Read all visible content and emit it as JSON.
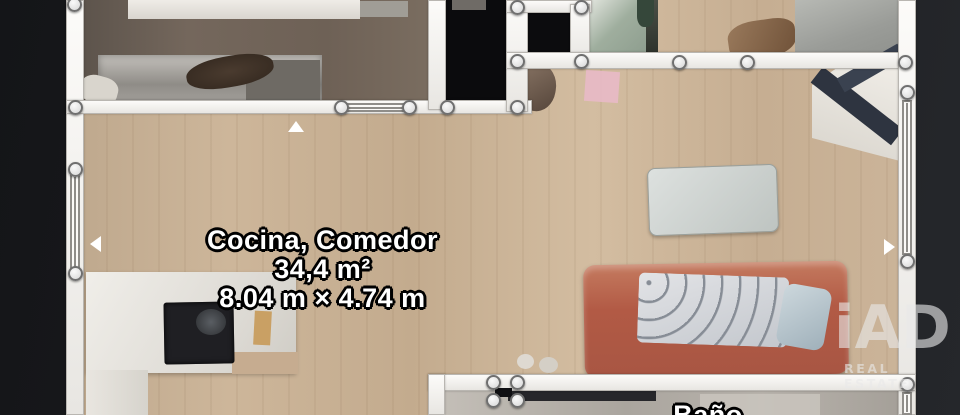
{
  "page": {
    "type": "floorplan-3d-scan-top-view"
  },
  "labels": {
    "main_room": {
      "name": "Cocina, Comedor",
      "area": "34,4 m²",
      "dimensions": "8.04 m × 4.74 m"
    },
    "bottom_room": {
      "name": "Baño"
    }
  },
  "watermark": {
    "logo": "iAD",
    "subtitle": "REAL ESTATE"
  },
  "colors": {
    "background": "#1c1d20",
    "wall": "#f4f2ef",
    "wall_node_fill": "#ececec",
    "wood_floor": "#c8ae93",
    "void_room": "#0b0b0d",
    "sofa": "#b25a45",
    "label_text": "#ffffff",
    "label_outline": "#000000",
    "watermark_gray": "#e9e9e9"
  },
  "scene": {
    "width": 960,
    "height": 415,
    "shapes": [
      {
        "name": "canvas-background",
        "interactable": false,
        "x": 0,
        "y": 0,
        "w": 960,
        "h": 415,
        "bg": "linear-gradient(100deg,#141518 0%,#1b1c1f 45%,#25272b 100%)"
      },
      {
        "name": "main-wood-floor",
        "interactable": false,
        "x": 80,
        "y": 0,
        "w": 828,
        "h": 415,
        "bg": "repeating-linear-gradient(90deg,rgba(90,60,30,0.06) 0 2px,rgba(0,0,0,0) 2px 26px),linear-gradient(90deg,#bfa98e 0%,#cdb69a 18%,#c3ab8e 40%,#d3bda1 62%,#c6ae92 82%,#cbb499 100%)"
      },
      {
        "name": "room-top-left-floor",
        "interactable": false,
        "x": 84,
        "y": 0,
        "w": 346,
        "h": 103,
        "bg": "linear-gradient(90deg,#5d544c,#74675c 30%,#6e6156 70%,#7a6d60)"
      },
      {
        "name": "bed-step",
        "interactable": false,
        "x": 350,
        "y": 1,
        "w": 58,
        "h": 16,
        "bg": "#a09d96"
      },
      {
        "name": "bed-white",
        "interactable": false,
        "x": 128,
        "y": 0,
        "w": 232,
        "h": 19,
        "bg": "linear-gradient(180deg,#efece7,#d9d5cf)"
      },
      {
        "name": "desk-unit",
        "interactable": false,
        "x": 98,
        "y": 55,
        "w": 224,
        "h": 49,
        "bg": "linear-gradient(180deg,#c4c1bc,#8f8c87 60%,#a5a29d)",
        "shadow": "inset 0 0 8px rgba(0,0,0,0.35)"
      },
      {
        "name": "desk-unit-shelf",
        "interactable": false,
        "x": 246,
        "y": 60,
        "w": 74,
        "h": 42,
        "bg": "#6e6a64"
      },
      {
        "name": "desk-chair-blob",
        "interactable": false,
        "x": 186,
        "y": 56,
        "w": 88,
        "h": 31,
        "bg": "radial-gradient(ellipse at 50% 50%,#4a3b2f,#32271e)",
        "radius": "45%",
        "rotate": -10
      },
      {
        "name": "pillow-blob",
        "interactable": false,
        "x": 80,
        "y": 76,
        "w": 38,
        "h": 28,
        "bg": "#d9d5cd",
        "radius": "40%",
        "rotate": 15
      },
      {
        "name": "void-room-a",
        "interactable": false,
        "x": 446,
        "y": 0,
        "w": 61,
        "h": 104,
        "bg": "#0b0b0d"
      },
      {
        "name": "void-room-a-object",
        "interactable": false,
        "x": 452,
        "y": 0,
        "w": 34,
        "h": 10,
        "bg": "#6f6b66"
      },
      {
        "name": "void-room-b",
        "interactable": false,
        "x": 528,
        "y": 12,
        "w": 44,
        "h": 42,
        "bg": "#0c0c0e"
      },
      {
        "name": "shower-room-floor",
        "interactable": false,
        "x": 588,
        "y": 0,
        "w": 68,
        "h": 53,
        "bg": "linear-gradient(135deg,#e3e6df,#9fae9e 45%,#8b9b8c)"
      },
      {
        "name": "shower-room-edge",
        "interactable": false,
        "x": 646,
        "y": 0,
        "w": 12,
        "h": 53,
        "bg": "linear-gradient(180deg,#4a4f46,#2e332c)"
      },
      {
        "name": "plant-dark",
        "interactable": false,
        "x": 637,
        "y": 0,
        "w": 17,
        "h": 27,
        "bg": "#35473a",
        "radius": "0 0 40% 40%"
      },
      {
        "name": "hall-furniture",
        "interactable": false,
        "x": 728,
        "y": 20,
        "w": 68,
        "h": 38,
        "bg": "linear-gradient(120deg,#9a7a5c,#6f5138)",
        "radius": "40% 30% 45% 35%",
        "rotate": -8
      },
      {
        "name": "room-top-right-floor",
        "interactable": false,
        "x": 795,
        "y": 0,
        "w": 103,
        "h": 57,
        "bg": "linear-gradient(160deg,#b7b9b4,#9a9c98 60%,#8f918d)"
      },
      {
        "name": "desk-top-right",
        "interactable": false,
        "x": 812,
        "y": 66,
        "w": 92,
        "h": 96,
        "bg": "linear-gradient(200deg,#f0ede7,#d8d4cc)",
        "clip": "polygon(30% 0,100% 0,100% 100%,0 75%,0 20%)"
      },
      {
        "name": "desk-beam-a",
        "interactable": false,
        "x": 806,
        "y": 96,
        "w": 102,
        "h": 20,
        "bg": "#2e3440",
        "rotate": 38
      },
      {
        "name": "desk-beam-b",
        "interactable": false,
        "x": 836,
        "y": 60,
        "w": 70,
        "h": 16,
        "bg": "#3a4250",
        "rotate": -30
      },
      {
        "name": "chair-mid",
        "interactable": false,
        "x": 516,
        "y": 63,
        "w": 40,
        "h": 48,
        "bg": "linear-gradient(140deg,#8a7666,#55453a)",
        "radius": "40% 50% 45% 45%",
        "rotate": 10
      },
      {
        "name": "pink-rug",
        "interactable": false,
        "x": 585,
        "y": 71,
        "w": 34,
        "h": 31,
        "bg": "#e7bac6",
        "rotate": 4,
        "opacity": 0.92
      },
      {
        "name": "coffee-table",
        "interactable": false,
        "x": 648,
        "y": 166,
        "w": 130,
        "h": 68,
        "bg": "linear-gradient(135deg,#dde1df,#bec4c1)",
        "border": "1px solid #99a09d",
        "radius": "8px",
        "rotate": -2,
        "shadow": "0 2px 3px rgba(0,0,0,0.25)"
      },
      {
        "name": "sofa",
        "interactable": false,
        "x": 584,
        "y": 263,
        "w": 264,
        "h": 113,
        "bg": "linear-gradient(180deg,#c47a5f,#b25a45 40%,#a85643)",
        "radius": "12px",
        "rotate": -1,
        "shadow": "inset 0 4px 6px rgba(255,255,255,0.25), 0 2px 4px rgba(0,0,0,0.3)"
      },
      {
        "name": "sofa-blanket",
        "interactable": false,
        "x": 638,
        "y": 275,
        "w": 150,
        "h": 70,
        "bg": "repeating-radial-gradient(circle at 10px 10px,#878d96 0 2px,transparent 3px 18px),linear-gradient(160deg,#e2e3e6,#c3c7cd)",
        "radius": "6px",
        "rotate": 2
      },
      {
        "name": "sofa-pillow",
        "interactable": false,
        "x": 780,
        "y": 286,
        "w": 48,
        "h": 62,
        "bg": "linear-gradient(140deg,#cdd8dd,#9fb0ba)",
        "radius": "10px",
        "rotate": 10
      },
      {
        "name": "kitchen-counter",
        "interactable": false,
        "x": 86,
        "y": 272,
        "w": 210,
        "h": 101,
        "bg": "linear-gradient(120deg,#f0eee9,#dcd9d3 70%,#cfccc5)",
        "shadow": "0 2px 4px rgba(0,0,0,0.25)"
      },
      {
        "name": "counter-notch-floor",
        "interactable": false,
        "x": 232,
        "y": 352,
        "w": 66,
        "h": 22,
        "bg": "#c6ac90"
      },
      {
        "name": "kitchen-counter-ext",
        "interactable": false,
        "x": 86,
        "y": 370,
        "w": 62,
        "h": 45,
        "bg": "linear-gradient(90deg,#e9e6e0,#d6d3cc)"
      },
      {
        "name": "stove",
        "interactable": false,
        "x": 164,
        "y": 302,
        "w": 70,
        "h": 62,
        "bg": "#1f1f23",
        "radius": "3px",
        "rotate": -1,
        "shadow": "inset 0 0 6px #000"
      },
      {
        "name": "stove-pan",
        "interactable": false,
        "x": 196,
        "y": 309,
        "w": 30,
        "h": 26,
        "bg": "radial-gradient(circle,#5a5e63,#2c2e31)",
        "radius": "50%"
      },
      {
        "name": "cutting-board",
        "interactable": false,
        "x": 254,
        "y": 311,
        "w": 17,
        "h": 34,
        "bg": "#c9a064",
        "rotate": 3
      },
      {
        "name": "floor-item-a",
        "interactable": false,
        "x": 517,
        "y": 354,
        "w": 17,
        "h": 15,
        "bg": "#ded9d1",
        "radius": "50%"
      },
      {
        "name": "floor-item-b",
        "interactable": false,
        "x": 539,
        "y": 357,
        "w": 19,
        "h": 16,
        "bg": "#d4cfc6",
        "radius": "50%"
      },
      {
        "name": "blue-bag",
        "interactable": false,
        "x": 458,
        "y": 398,
        "w": 38,
        "h": 17,
        "bg": "linear-gradient(120deg,#4a66b0,#2c3f86)",
        "radius": "6px 6px 0 0"
      },
      {
        "name": "bathroom-floor",
        "interactable": false,
        "x": 445,
        "y": 390,
        "w": 453,
        "h": 25,
        "bg": "linear-gradient(90deg,#c3beb7,#aaa59e 40%,#b8b3ac 70%,#a5a099)"
      },
      {
        "name": "bathroom-dark-strip",
        "interactable": false,
        "x": 508,
        "y": 390,
        "w": 148,
        "h": 11,
        "bg": "#26262a"
      },
      {
        "name": "bathroom-fixture",
        "interactable": false,
        "x": 700,
        "y": 394,
        "w": 120,
        "h": 21,
        "bg": "#c9c4bd",
        "opacity": 0.85
      },
      {
        "name": "wall-left",
        "interactable": true,
        "cls": "wall",
        "x": 66,
        "y": 0,
        "w": 18,
        "h": 415
      },
      {
        "name": "wall-top-band",
        "interactable": true,
        "cls": "wall",
        "x": 66,
        "y": 100,
        "w": 466,
        "h": 14
      },
      {
        "name": "wall-topleft-right",
        "interactable": true,
        "cls": "wall",
        "x": 428,
        "y": 0,
        "w": 18,
        "h": 110
      },
      {
        "name": "wall-mid-vertical",
        "interactable": true,
        "cls": "wall",
        "x": 506,
        "y": 0,
        "w": 22,
        "h": 112
      },
      {
        "name": "wall-mid-top",
        "interactable": true,
        "cls": "wall",
        "x": 506,
        "y": 0,
        "w": 86,
        "h": 13
      },
      {
        "name": "wall-mid-vertical-2",
        "interactable": true,
        "cls": "wall",
        "x": 570,
        "y": 4,
        "w": 20,
        "h": 60
      },
      {
        "name": "wall-top-long",
        "interactable": true,
        "cls": "wall",
        "x": 506,
        "y": 52,
        "w": 410,
        "h": 17
      },
      {
        "name": "wall-right",
        "interactable": true,
        "cls": "wall",
        "x": 898,
        "y": 0,
        "w": 18,
        "h": 415
      },
      {
        "name": "wall-bottom",
        "interactable": true,
        "cls": "wall",
        "x": 428,
        "y": 374,
        "w": 488,
        "h": 17
      },
      {
        "name": "wall-bathroom-left",
        "interactable": true,
        "cls": "wall",
        "x": 428,
        "y": 374,
        "w": 17,
        "h": 41
      },
      {
        "name": "window-left",
        "interactable": true,
        "cls": "window winv",
        "x": 70,
        "y": 174,
        "w": 10,
        "h": 96
      },
      {
        "name": "window-top",
        "interactable": true,
        "cls": "window winh",
        "x": 345,
        "y": 103,
        "w": 62,
        "h": 9
      },
      {
        "name": "window-right",
        "interactable": true,
        "cls": "window winv",
        "x": 902,
        "y": 100,
        "w": 10,
        "h": 155
      },
      {
        "name": "window-right-bottom",
        "interactable": true,
        "cls": "window winv",
        "x": 902,
        "y": 392,
        "w": 10,
        "h": 23
      },
      {
        "name": "door-marker",
        "interactable": true,
        "cls": "doorm",
        "x": 495,
        "y": 388,
        "w": 17,
        "h": 9,
        "bg": "#101013"
      },
      {
        "name": "direction-marker-up",
        "interactable": true,
        "cls": "tri",
        "x": 288,
        "y": 121,
        "w": 16,
        "h": 11,
        "bg": "#ffffff",
        "clip": "polygon(50% 0,100% 100%,0 100%)"
      },
      {
        "name": "direction-marker-left",
        "interactable": true,
        "cls": "tri",
        "x": 90,
        "y": 236,
        "w": 11,
        "h": 16,
        "bg": "#ffffff",
        "clip": "polygon(0 50%,100% 0,100% 100%)"
      },
      {
        "name": "direction-marker-right",
        "interactable": true,
        "cls": "tri",
        "x": 884,
        "y": 239,
        "w": 11,
        "h": 16,
        "bg": "#ffffff",
        "clip": "polygon(100% 50%,0 0,0 100%)"
      },
      {
        "name": "wall-node",
        "interactable": true,
        "cls": "node",
        "x": 67,
        "y": -3,
        "w": 15,
        "h": 15
      },
      {
        "name": "wall-node",
        "interactable": true,
        "cls": "node",
        "x": 68,
        "y": 100,
        "w": 15,
        "h": 15
      },
      {
        "name": "wall-node",
        "interactable": true,
        "cls": "node",
        "x": 68,
        "y": 162,
        "w": 15,
        "h": 15
      },
      {
        "name": "wall-node",
        "interactable": true,
        "cls": "node",
        "x": 68,
        "y": 266,
        "w": 15,
        "h": 15
      },
      {
        "name": "wall-node",
        "interactable": true,
        "cls": "node",
        "x": 334,
        "y": 100,
        "w": 15,
        "h": 15
      },
      {
        "name": "wall-node",
        "interactable": true,
        "cls": "node",
        "x": 402,
        "y": 100,
        "w": 15,
        "h": 15
      },
      {
        "name": "wall-node",
        "interactable": true,
        "cls": "node",
        "x": 440,
        "y": 100,
        "w": 15,
        "h": 15
      },
      {
        "name": "wall-node",
        "interactable": true,
        "cls": "node",
        "x": 510,
        "y": 100,
        "w": 15,
        "h": 15
      },
      {
        "name": "wall-node",
        "interactable": true,
        "cls": "node",
        "x": 510,
        "y": 0,
        "w": 15,
        "h": 15
      },
      {
        "name": "wall-node",
        "interactable": true,
        "cls": "node",
        "x": 574,
        "y": 0,
        "w": 15,
        "h": 15
      },
      {
        "name": "wall-node",
        "interactable": true,
        "cls": "node",
        "x": 510,
        "y": 54,
        "w": 15,
        "h": 15
      },
      {
        "name": "wall-node",
        "interactable": true,
        "cls": "node",
        "x": 574,
        "y": 54,
        "w": 15,
        "h": 15
      },
      {
        "name": "wall-node",
        "interactable": true,
        "cls": "node",
        "x": 672,
        "y": 55,
        "w": 15,
        "h": 15
      },
      {
        "name": "wall-node",
        "interactable": true,
        "cls": "node",
        "x": 740,
        "y": 55,
        "w": 15,
        "h": 15
      },
      {
        "name": "wall-node",
        "interactable": true,
        "cls": "node",
        "x": 898,
        "y": 55,
        "w": 15,
        "h": 15
      },
      {
        "name": "wall-node",
        "interactable": true,
        "cls": "node",
        "x": 900,
        "y": 85,
        "w": 15,
        "h": 15
      },
      {
        "name": "wall-node",
        "interactable": true,
        "cls": "node",
        "x": 900,
        "y": 254,
        "w": 15,
        "h": 15
      },
      {
        "name": "wall-node",
        "interactable": true,
        "cls": "node",
        "x": 900,
        "y": 377,
        "w": 15,
        "h": 15
      },
      {
        "name": "wall-node",
        "interactable": true,
        "cls": "node",
        "x": 486,
        "y": 375,
        "w": 15,
        "h": 15
      },
      {
        "name": "wall-node",
        "interactable": true,
        "cls": "node",
        "x": 510,
        "y": 375,
        "w": 15,
        "h": 15
      },
      {
        "name": "wall-node",
        "interactable": true,
        "cls": "node",
        "x": 486,
        "y": 393,
        "w": 15,
        "h": 15
      },
      {
        "name": "wall-node",
        "interactable": true,
        "cls": "node",
        "x": 510,
        "y": 393,
        "w": 15,
        "h": 15
      }
    ]
  }
}
